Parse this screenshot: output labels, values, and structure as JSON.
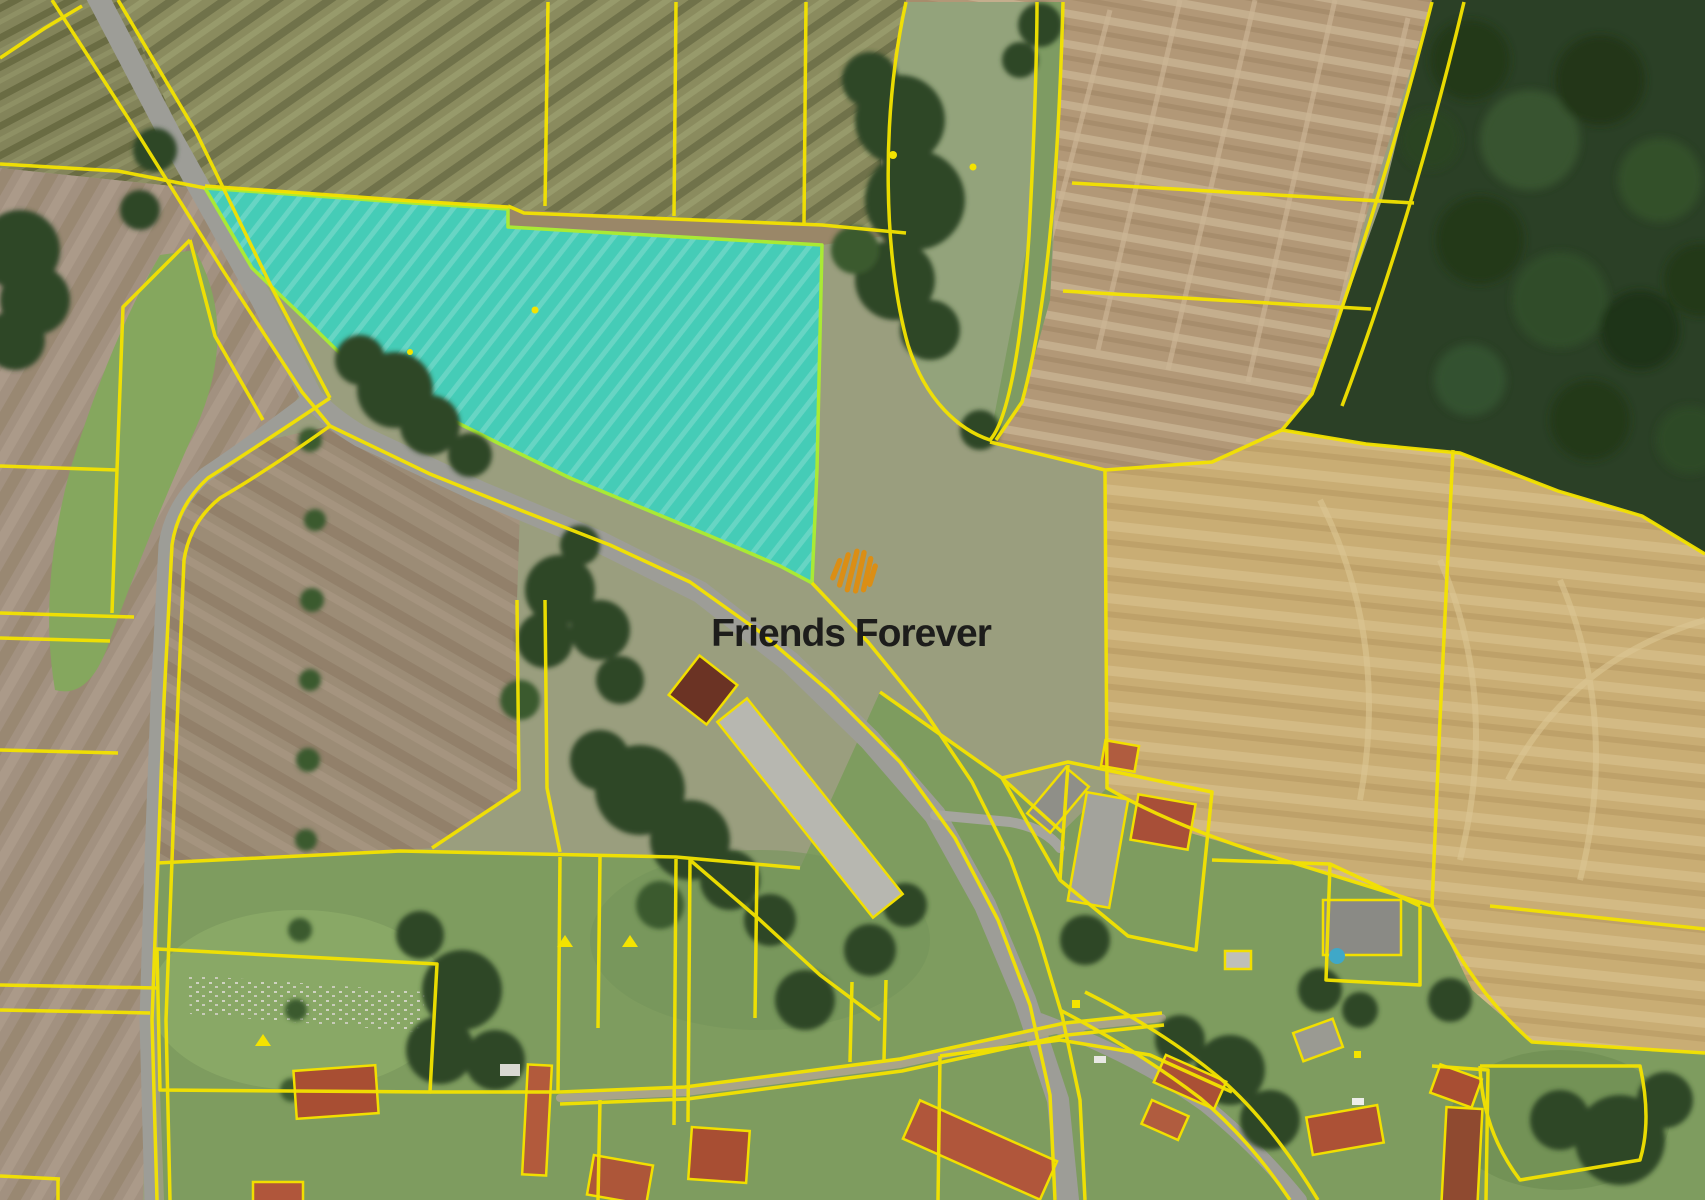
{
  "page": {
    "title": "Aerial cadastral map with highlighted parcel",
    "width_px": 1705,
    "height_px": 1200
  },
  "watermark": {
    "brand": "Friends Forever",
    "logo_color": "#DB8E15",
    "logo_color_dark": "#C57D0C",
    "text_color": "#1D1D1B"
  },
  "map": {
    "type": "aerial-cadastral",
    "highlight": {
      "name": "offered-parcel",
      "fill": "#2FD7C5",
      "fill_opacity": "0.8",
      "stroke": "#A9EA35"
    },
    "cadastral_line_color": "#F4E300",
    "feature_colors": {
      "forest": "#2B4026",
      "plowed_field": "#B29877",
      "stubble_field": "#C9AD74",
      "olive_field": "#83845A",
      "meadow": "#85A75E",
      "pasture": "#9A9E7E",
      "village_grass": "#7E9C5F",
      "road": "#9D9D97",
      "roof_red": "#A84E33",
      "roof_grey": "#B7B7B0"
    }
  }
}
